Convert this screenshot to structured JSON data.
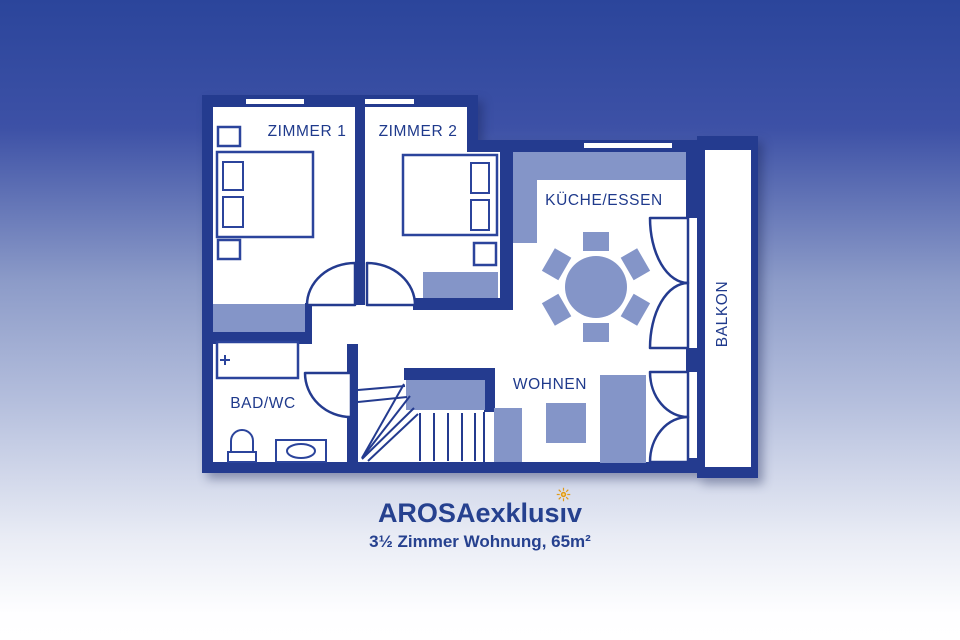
{
  "branding": {
    "title_pre": "AROSAexklus",
    "title_i": "ı",
    "title_post": "v",
    "title_full": "AROSAexklusiv",
    "subtitle": "3½ Zimmer Wohnung, 65m²",
    "title_color": "#26418F",
    "sun_icon_color": "#E09A18"
  },
  "floorplan": {
    "rooms": [
      {
        "id": "zimmer1",
        "label": "ZIMMER 1"
      },
      {
        "id": "zimmer2",
        "label": "ZIMMER 2"
      },
      {
        "id": "kueche_essen",
        "label": "KÜCHE/ESSEN"
      },
      {
        "id": "wohnen",
        "label": "WOHNEN"
      },
      {
        "id": "bad_wc",
        "label": "BAD/WC"
      },
      {
        "id": "balkon",
        "label": "BALKON"
      }
    ],
    "bathtub_faucet_mark": "+",
    "colors": {
      "wall": "#243B8F",
      "furniture": "#8495C8",
      "floor": "#FFFFFF",
      "label_text": "#1F3A8C",
      "background_top": "#2B459B",
      "background_bottom": "#FFFFFF"
    }
  }
}
